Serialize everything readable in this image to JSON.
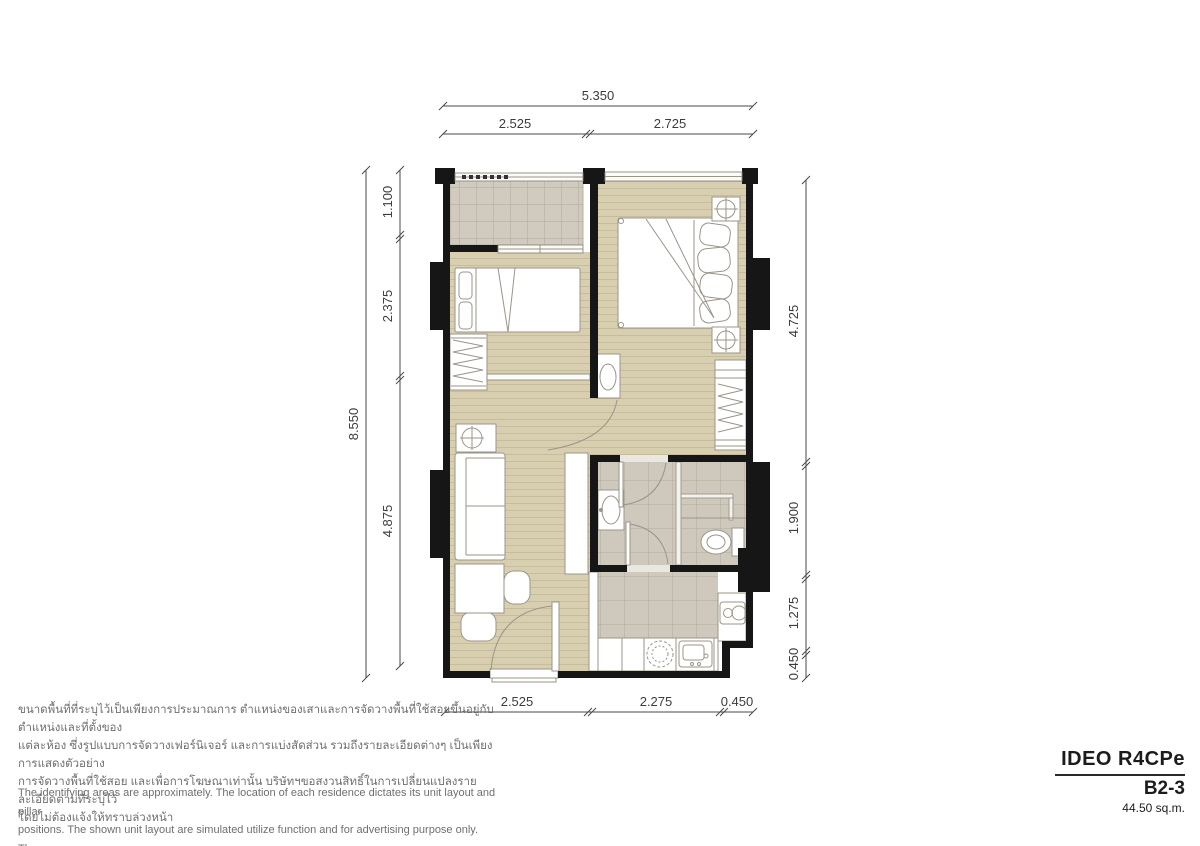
{
  "title_block": {
    "project": "IDEO R4CPe",
    "unit": "B2-3",
    "area": "44.50 sq.m."
  },
  "disclaimer_th": {
    "lines": [
      "ขนาดพื้นที่ที่ระบุไว้เป็นเพียงการประมาณการ ตำแหน่งของเสาและการจัดวางพื้นที่ใช้สอยขึ้นอยู่กับตำแหน่งและที่ตั้งของ",
      "แต่ละห้อง ซึ่งรูปแบบการจัดวางเฟอร์นิเจอร์ และการแบ่งสัดส่วน รวมถึงรายละเอียดต่างๆ เป็นเพียงการแสดงตัวอย่าง",
      "การจัดวางพื้นที่ใช้สอย และเพื่อการโฆษณาเท่านั้น บริษัทฯขอสงวนสิทธิ์ในการเปลี่ยนแปลงรายละเอียดตามที่ระบุไว้",
      "โดยไม่ต้องแจ้งให้ทราบล่วงหน้า"
    ]
  },
  "disclaimer_en": {
    "lines": [
      "The identifying areas are approximately. The location of each residence dictates its unit layout and pillar",
      "positions. The shown unit layout are simulated utilize function and for advertising purpose only. The company",
      "reserves the right to change the project's details without prior notice."
    ]
  },
  "dimensions": {
    "top_overall": "5.350",
    "top": [
      "2.525",
      "2.725"
    ],
    "left_overall": "8.550",
    "left": [
      "1.100",
      "2.375",
      "4.875"
    ],
    "right": [
      "4.725",
      "1.900",
      "1.275",
      "0.450"
    ],
    "bottom": [
      "2.525",
      "2.275",
      "0.450"
    ]
  },
  "colors": {
    "wall": "#161616",
    "wood_floor": "#d8cfb0",
    "wood_line": "#c7bc9c",
    "tile_floor": "#d1cbbf",
    "tile_line": "#b0aa9d",
    "furniture_line": "#9b958a",
    "dimension_text": "#3c3c3c",
    "disclaimer_text": "#6f6f6f"
  }
}
